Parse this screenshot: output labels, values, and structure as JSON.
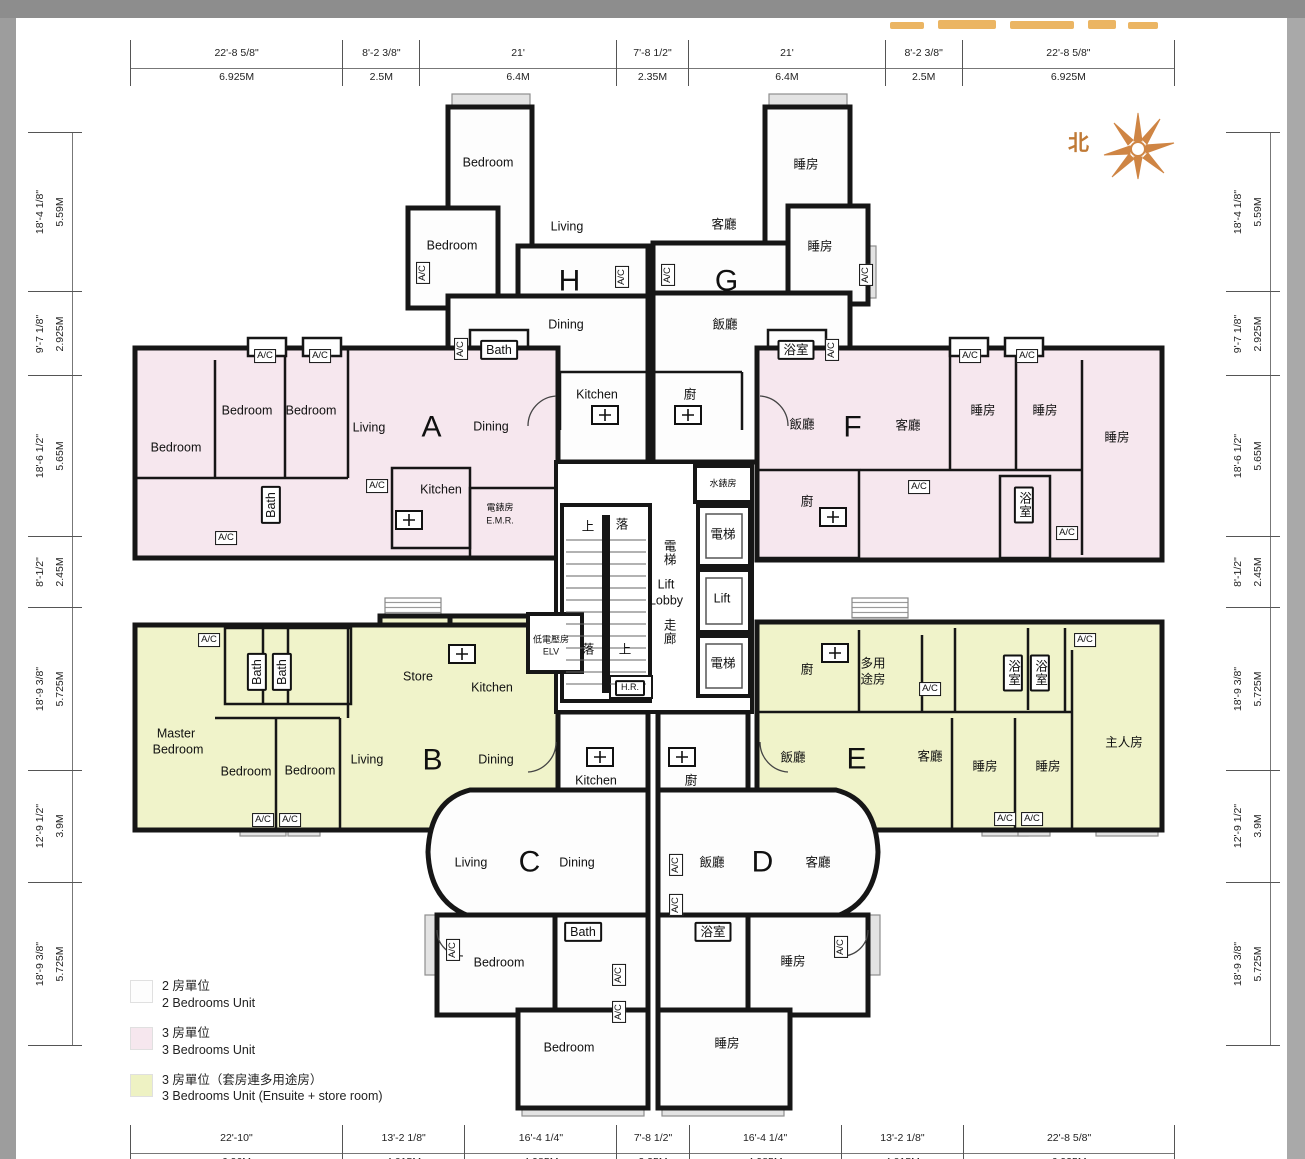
{
  "north": {
    "label": "北"
  },
  "legend": {
    "items": [
      {
        "swatch": "#fdfdfd",
        "zh": "2 房單位",
        "en": "2 Bedrooms Unit"
      },
      {
        "swatch": "#f6e7ee",
        "zh": "3 房單位",
        "en": "3 Bedrooms Unit"
      },
      {
        "swatch": "#eef2c3",
        "zh": "3 房單位（套房連多用途房）",
        "en": "3 Bedrooms Unit (Ensuite + store room)"
      }
    ]
  },
  "colors": {
    "wall": "#161616",
    "unit_2bed": "#fdfdfd",
    "unit_3bed": "#f6e7ee",
    "unit_3bed_ensuite": "#f0f3ca",
    "north_accent": "#c8803e"
  },
  "dimensions": {
    "top": [
      {
        "ft": "22'-8 5/8\"",
        "m": "6.925M",
        "val": 6.925
      },
      {
        "ft": "8'-2 3/8\"",
        "m": "2.5M",
        "val": 2.5
      },
      {
        "ft": "21'",
        "m": "6.4M",
        "val": 6.4
      },
      {
        "ft": "7'-8 1/2\"",
        "m": "2.35M",
        "val": 2.35
      },
      {
        "ft": "21'",
        "m": "6.4M",
        "val": 6.4
      },
      {
        "ft": "8'-2 3/8\"",
        "m": "2.5M",
        "val": 2.5
      },
      {
        "ft": "22'-8 5/8\"",
        "m": "6.925M",
        "val": 6.925
      }
    ],
    "bottom": [
      {
        "ft": "22'-10\"",
        "m": "6.96M",
        "val": 6.96
      },
      {
        "ft": "13'-2 1/8\"",
        "m": "4.015M",
        "val": 4.015
      },
      {
        "ft": "16'-4 1/4\"",
        "m": "4.985M",
        "val": 4.985
      },
      {
        "ft": "7'-8 1/2\"",
        "m": "2.35M",
        "val": 2.35
      },
      {
        "ft": "16'-4 1/4\"",
        "m": "4.985M",
        "val": 4.985
      },
      {
        "ft": "13'-2 1/8\"",
        "m": "4.015M",
        "val": 4.015
      },
      {
        "ft": "22'-8 5/8\"",
        "m": "6.925M",
        "val": 6.925
      }
    ],
    "left": [
      {
        "ft": "18'-4 1/8\"",
        "m": "5.59M",
        "val": 5.59
      },
      {
        "ft": "9'-7 1/8\"",
        "m": "2.925M",
        "val": 2.925
      },
      {
        "ft": "18'-6 1/2\"",
        "m": "5.65M",
        "val": 5.65
      },
      {
        "ft": "8'-1/2\"",
        "m": "2.45M",
        "val": 2.45
      },
      {
        "ft": "18'-9 3/8\"",
        "m": "5.725M",
        "val": 5.725
      },
      {
        "ft": "12'-9 1/2\"",
        "m": "3.9M",
        "val": 3.9
      },
      {
        "ft": "18'-9 3/8\"",
        "m": "5.725M",
        "val": 5.725
      }
    ],
    "right": [
      {
        "ft": "18'-4 1/8\"",
        "m": "5.59M",
        "val": 5.59
      },
      {
        "ft": "9'-7 1/8\"",
        "m": "2.925M",
        "val": 2.925
      },
      {
        "ft": "18'-6 1/2\"",
        "m": "5.65M",
        "val": 5.65
      },
      {
        "ft": "8'-1/2\"",
        "m": "2.45M",
        "val": 2.45
      },
      {
        "ft": "18'-9 3/8\"",
        "m": "5.725M",
        "val": 5.725
      },
      {
        "ft": "12'-9 1/2\"",
        "m": "3.9M",
        "val": 3.9
      },
      {
        "ft": "18'-9 3/8\"",
        "m": "5.725M",
        "val": 5.725
      }
    ]
  },
  "plan_labels": [
    {
      "t": "Bedroom",
      "x": 488,
      "y": 163
    },
    {
      "t": "Bedroom",
      "x": 452,
      "y": 246
    },
    {
      "t": "Living",
      "x": 567,
      "y": 227
    },
    {
      "t": "H",
      "x": 570,
      "y": 281,
      "k": "unit"
    },
    {
      "t": "Dining",
      "x": 566,
      "y": 325
    },
    {
      "t": "Bath",
      "x": 499,
      "y": 350,
      "b": 1
    },
    {
      "t": "Kitchen",
      "x": 597,
      "y": 395
    },
    {
      "t": "A/C",
      "x": 423,
      "y": 273,
      "v": 1,
      "k": "ac"
    },
    {
      "t": "A/C",
      "x": 461,
      "y": 349,
      "v": 1,
      "k": "ac"
    },
    {
      "t": "A/C",
      "x": 622,
      "y": 277,
      "v": 1,
      "k": "ac"
    },
    {
      "t": "睡房",
      "x": 806,
      "y": 165
    },
    {
      "t": "客廳",
      "x": 724,
      "y": 225
    },
    {
      "t": "G",
      "x": 727,
      "y": 281,
      "k": "unit"
    },
    {
      "t": "睡房",
      "x": 820,
      "y": 247
    },
    {
      "t": "飯廳",
      "x": 725,
      "y": 325
    },
    {
      "t": "浴室",
      "x": 796,
      "y": 350,
      "b": 1
    },
    {
      "t": "廚",
      "x": 690,
      "y": 395
    },
    {
      "t": "A/C",
      "x": 668,
      "y": 275,
      "v": 1,
      "k": "ac"
    },
    {
      "t": "A/C",
      "x": 866,
      "y": 275,
      "v": 1,
      "k": "ac"
    },
    {
      "t": "A/C",
      "x": 832,
      "y": 350,
      "v": 1,
      "k": "ac"
    },
    {
      "t": "A/C",
      "x": 265,
      "y": 356,
      "k": "ac"
    },
    {
      "t": "A/C",
      "x": 320,
      "y": 356,
      "k": "ac"
    },
    {
      "t": "Bedroom",
      "x": 247,
      "y": 411
    },
    {
      "t": "Bedroom",
      "x": 311,
      "y": 411
    },
    {
      "t": "Bedroom",
      "x": 176,
      "y": 448
    },
    {
      "t": "Living",
      "x": 369,
      "y": 428
    },
    {
      "t": "A",
      "x": 432,
      "y": 427,
      "k": "unit"
    },
    {
      "t": "Dining",
      "x": 491,
      "y": 427
    },
    {
      "t": "Bath",
      "x": 271,
      "y": 505,
      "v": 1,
      "b": 1
    },
    {
      "t": "A/C",
      "x": 377,
      "y": 486,
      "k": "ac"
    },
    {
      "t": "Kitchen",
      "x": 441,
      "y": 490
    },
    {
      "t": "電錶房",
      "x": 500,
      "y": 508,
      "k": "tiny"
    },
    {
      "t": "E.M.R.",
      "x": 500,
      "y": 521,
      "k": "tiny"
    },
    {
      "t": "A/C",
      "x": 226,
      "y": 538,
      "k": "ac"
    },
    {
      "t": "A/C",
      "x": 970,
      "y": 356,
      "k": "ac"
    },
    {
      "t": "A/C",
      "x": 1027,
      "y": 356,
      "k": "ac"
    },
    {
      "t": "飯廳",
      "x": 802,
      "y": 425
    },
    {
      "t": "F",
      "x": 853,
      "y": 427,
      "k": "unit"
    },
    {
      "t": "客廳",
      "x": 908,
      "y": 426
    },
    {
      "t": "睡房",
      "x": 983,
      "y": 411
    },
    {
      "t": "睡房",
      "x": 1045,
      "y": 411
    },
    {
      "t": "睡房",
      "x": 1117,
      "y": 438
    },
    {
      "t": "廚",
      "x": 807,
      "y": 502
    },
    {
      "t": "A/C",
      "x": 919,
      "y": 487,
      "k": "ac"
    },
    {
      "t": "浴室",
      "x": 1024,
      "y": 505,
      "st": 1,
      "b": 1
    },
    {
      "t": "A/C",
      "x": 1067,
      "y": 533,
      "k": "ac"
    },
    {
      "t": "水錶房",
      "x": 723,
      "y": 484,
      "k": "tiny"
    },
    {
      "t": "電梯",
      "x": 723,
      "y": 535
    },
    {
      "t": "Lift",
      "x": 722,
      "y": 599
    },
    {
      "t": "電梯",
      "x": 723,
      "y": 664
    },
    {
      "t": "電梯",
      "x": 668,
      "y": 553,
      "st": 1
    },
    {
      "t": "Lift",
      "x": 666,
      "y": 585
    },
    {
      "t": "Lobby",
      "x": 666,
      "y": 601
    },
    {
      "t": "走廊",
      "x": 668,
      "y": 632,
      "st": 1
    },
    {
      "t": "上",
      "x": 588,
      "y": 527
    },
    {
      "t": "落",
      "x": 622,
      "y": 525
    },
    {
      "t": "落",
      "x": 588,
      "y": 650
    },
    {
      "t": "上",
      "x": 625,
      "y": 650
    },
    {
      "t": "低電壓房",
      "x": 551,
      "y": 640,
      "k": "tiny"
    },
    {
      "t": "ELV",
      "x": 551,
      "y": 652,
      "k": "tiny"
    },
    {
      "t": "H.R.",
      "x": 630,
      "y": 688,
      "k": "tiny",
      "b": 1
    },
    {
      "t": "A/C",
      "x": 209,
      "y": 640,
      "k": "ac"
    },
    {
      "t": "Bath",
      "x": 257,
      "y": 672,
      "v": 1,
      "b": 1
    },
    {
      "t": "Bath",
      "x": 282,
      "y": 672,
      "v": 1,
      "b": 1
    },
    {
      "t": "Store",
      "x": 418,
      "y": 677
    },
    {
      "t": "Kitchen",
      "x": 492,
      "y": 688
    },
    {
      "t": "Master",
      "x": 176,
      "y": 734
    },
    {
      "t": "Bedroom",
      "x": 178,
      "y": 750
    },
    {
      "t": "Bedroom",
      "x": 246,
      "y": 772
    },
    {
      "t": "Bedroom",
      "x": 310,
      "y": 771
    },
    {
      "t": "Living",
      "x": 367,
      "y": 760
    },
    {
      "t": "B",
      "x": 433,
      "y": 760,
      "k": "unit"
    },
    {
      "t": "Dining",
      "x": 496,
      "y": 760
    },
    {
      "t": "A/C",
      "x": 263,
      "y": 820,
      "k": "ac"
    },
    {
      "t": "A/C",
      "x": 290,
      "y": 820,
      "k": "ac"
    },
    {
      "t": "廚",
      "x": 807,
      "y": 670
    },
    {
      "t": "多用",
      "x": 873,
      "y": 664
    },
    {
      "t": "途房",
      "x": 873,
      "y": 680
    },
    {
      "t": "A/C",
      "x": 930,
      "y": 689,
      "k": "ac"
    },
    {
      "t": "浴室",
      "x": 1013,
      "y": 673,
      "st": 1,
      "b": 1
    },
    {
      "t": "浴室",
      "x": 1040,
      "y": 673,
      "st": 1,
      "b": 1
    },
    {
      "t": "A/C",
      "x": 1085,
      "y": 640,
      "k": "ac"
    },
    {
      "t": "飯廳",
      "x": 793,
      "y": 758
    },
    {
      "t": "E",
      "x": 857,
      "y": 759,
      "k": "unit"
    },
    {
      "t": "客廳",
      "x": 930,
      "y": 757
    },
    {
      "t": "睡房",
      "x": 985,
      "y": 767
    },
    {
      "t": "睡房",
      "x": 1048,
      "y": 767
    },
    {
      "t": "主人房",
      "x": 1124,
      "y": 743
    },
    {
      "t": "A/C",
      "x": 1005,
      "y": 819,
      "k": "ac"
    },
    {
      "t": "A/C",
      "x": 1032,
      "y": 819,
      "k": "ac"
    },
    {
      "t": "Living",
      "x": 471,
      "y": 863
    },
    {
      "t": "C",
      "x": 530,
      "y": 862,
      "k": "unit"
    },
    {
      "t": "Dining",
      "x": 577,
      "y": 863
    },
    {
      "t": "Kitchen",
      "x": 596,
      "y": 781
    },
    {
      "t": "Bath",
      "x": 583,
      "y": 932,
      "b": 1
    },
    {
      "t": "Bedroom",
      "x": 499,
      "y": 963
    },
    {
      "t": "A/C",
      "x": 453,
      "y": 950,
      "v": 1,
      "k": "ac"
    },
    {
      "t": "A/C",
      "x": 619,
      "y": 975,
      "v": 1,
      "k": "ac"
    },
    {
      "t": "A/C",
      "x": 619,
      "y": 1012,
      "v": 1,
      "k": "ac"
    },
    {
      "t": "Bedroom",
      "x": 569,
      "y": 1048
    },
    {
      "t": "飯廳",
      "x": 712,
      "y": 863
    },
    {
      "t": "D",
      "x": 763,
      "y": 862,
      "k": "unit"
    },
    {
      "t": "客廳",
      "x": 818,
      "y": 863
    },
    {
      "t": "廚",
      "x": 691,
      "y": 781
    },
    {
      "t": "A/C",
      "x": 676,
      "y": 865,
      "v": 1,
      "k": "ac"
    },
    {
      "t": "A/C",
      "x": 676,
      "y": 905,
      "v": 1,
      "k": "ac"
    },
    {
      "t": "浴室",
      "x": 713,
      "y": 932,
      "b": 1
    },
    {
      "t": "睡房",
      "x": 793,
      "y": 962
    },
    {
      "t": "A/C",
      "x": 841,
      "y": 947,
      "v": 1,
      "k": "ac"
    },
    {
      "t": "睡房",
      "x": 727,
      "y": 1044
    }
  ]
}
